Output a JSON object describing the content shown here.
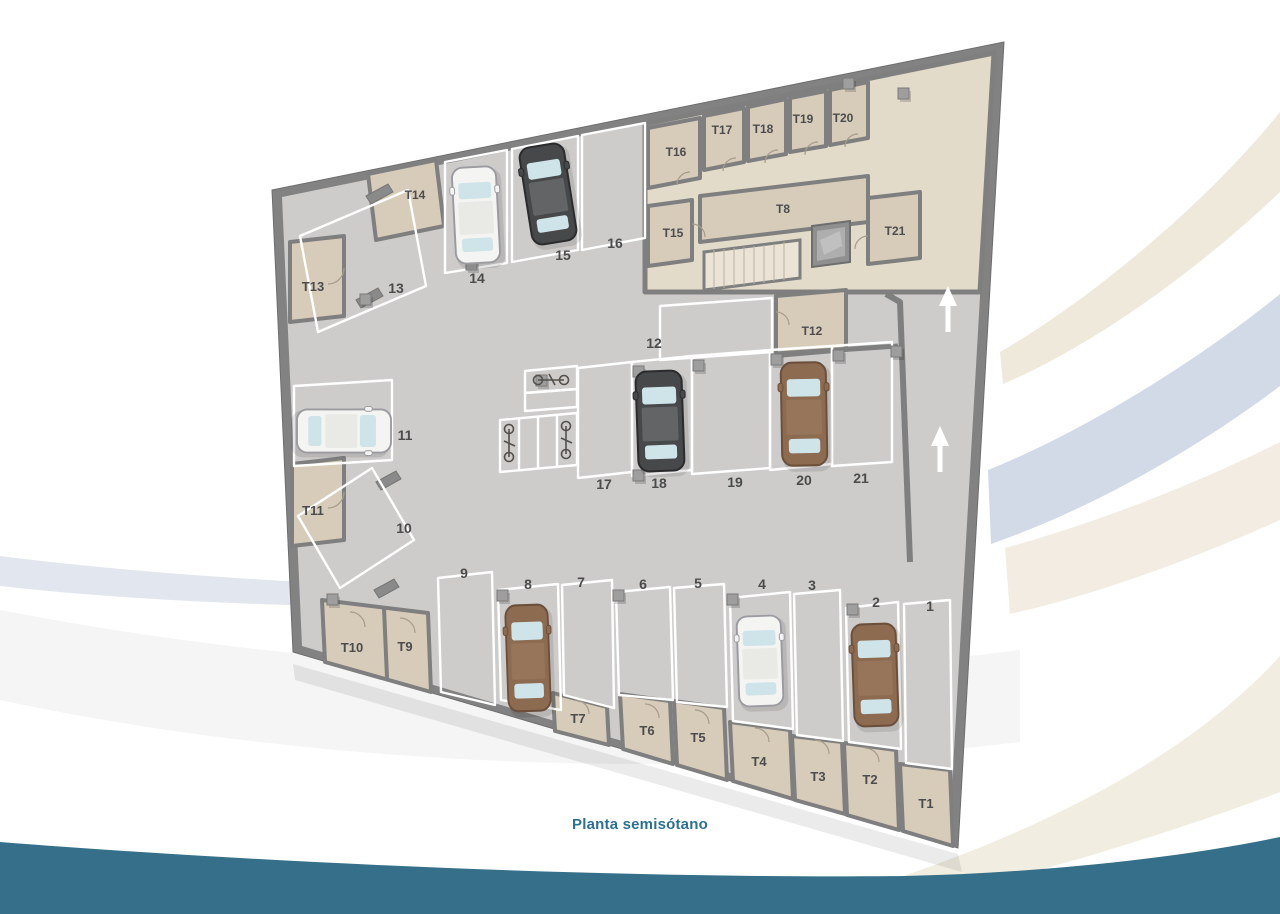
{
  "title": "Planta semisótano",
  "labels": {
    "p1": "1",
    "p2": "2",
    "p3": "3",
    "p4": "4",
    "p5": "5",
    "p6": "6",
    "p7": "7",
    "p8": "8",
    "p9": "9",
    "p10": "10",
    "p11": "11",
    "p12": "12",
    "p13": "13",
    "p14": "14",
    "p15": "15",
    "p16": "16",
    "p17": "17",
    "p18": "18",
    "p19": "19",
    "p20": "20",
    "p21": "21",
    "t1": "T1",
    "t2": "T2",
    "t3": "T3",
    "t4": "T4",
    "t5": "T5",
    "t6": "T6",
    "t7": "T7",
    "t8": "T8",
    "t9": "T9",
    "t10": "T10",
    "t11": "T11",
    "t12": "T12",
    "t13": "T13",
    "t14": "T14",
    "t15": "T15",
    "t16": "T16",
    "t17": "T17",
    "t18": "T18",
    "t19": "T19",
    "t20": "T20",
    "t21": "T21"
  },
  "palette": {
    "wall": "#828282",
    "floor": "#cdcccb",
    "corridor_tile": "#e3dbca",
    "storage_room": "#d7ccba",
    "parking_line": "#ffffff",
    "label_text": "#4c4c4c",
    "footer_band": "#356f89",
    "title_text": "#2d7090",
    "swoosh_beige": "#efe9db",
    "swoosh_blue": "#cdd6e6",
    "swoosh_gray": "#dde2eb"
  },
  "cars": {
    "white": "#f4f4f2",
    "dark": "#47484a",
    "brown": "#8d6b51",
    "glass": "#cfe4e9",
    "occupied_spaces": {
      "white": [
        "14",
        "11",
        "4"
      ],
      "dark": [
        "15",
        "18"
      ],
      "brown": [
        "20",
        "8",
        "2"
      ]
    }
  },
  "ramp": {
    "arrow_glyph": "↑",
    "arrow_count": 2,
    "direction": "up"
  },
  "bikes": {
    "slot_count": 6,
    "bike_count": 3
  }
}
